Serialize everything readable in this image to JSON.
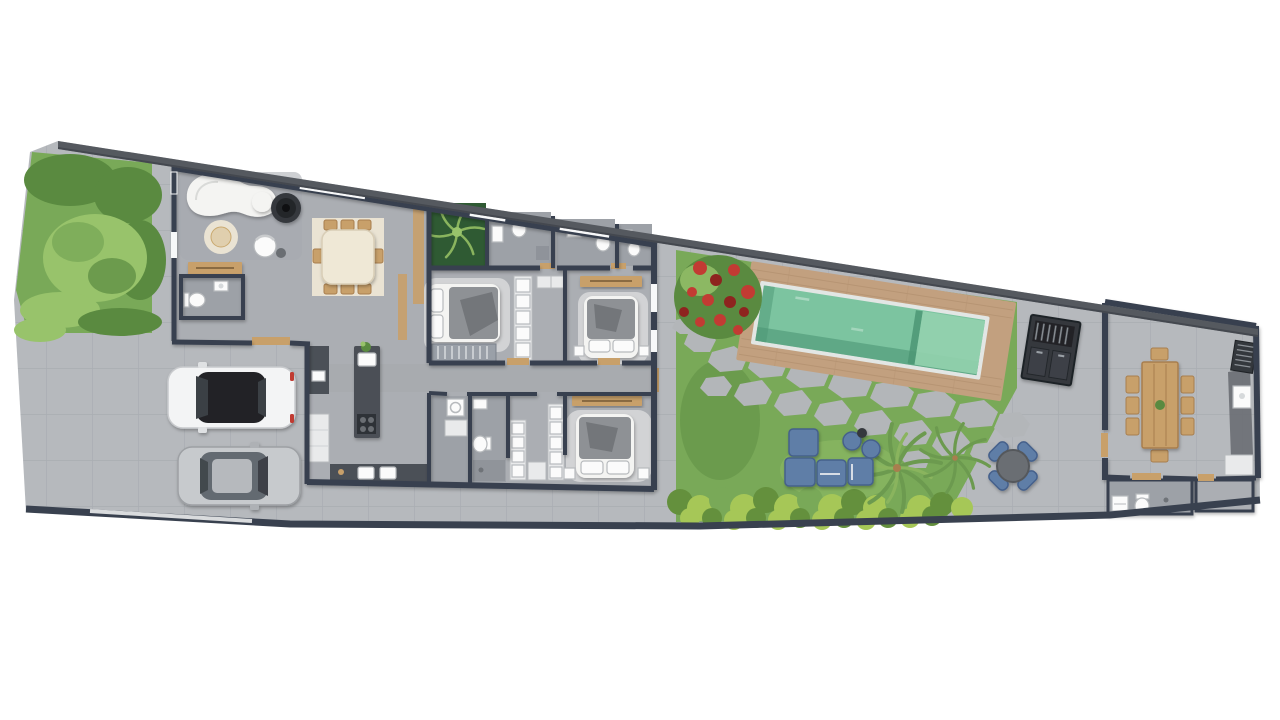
{
  "document": {
    "kind": "architectural-floor-plan-render",
    "view": "top-down site plan",
    "visible_text": []
  },
  "colors": {
    "background": "#ffffff",
    "paving": "#b6b9bd",
    "indoor_floor": "#abaeb3",
    "bath_floor": "#9da1a7",
    "hall_floor": "#a6a9ae",
    "wall": "#39414f",
    "boundary_top": "#55595f",
    "window_white": "#f7f8f9",
    "grass": "#79a958",
    "grass_dark": "#5a8a40",
    "grass_light": "#98c36b",
    "hedge_light": "#a6c757",
    "hedge_dark": "#64903d",
    "planter": "#2f5a33",
    "palm": "#6c9a4f",
    "palm_light": "#8ab45e",
    "flower_red": "#c23b33",
    "flower_dark": "#8e241f",
    "pool_water": "#7cc4a0",
    "pool_deep": "#4c9674",
    "pool_ledge": "#93d2ae",
    "pool_trim": "#e2e6e4",
    "deck": "#c2a07f",
    "deck_line": "#ae8c6b",
    "wood": "#c8a06a",
    "wood_dark": "#a87e4e",
    "rug_cream": "#eae3d3",
    "rug_gray": "#d8d9db",
    "sofa_white": "#f4f4f2",
    "blanket": "#8e9195",
    "blanket_dark": "#73767a",
    "fixture": "#fbfbfb",
    "fixture_stroke": "#b7babd",
    "charcoal": "#34383d",
    "metal": "#6a6e73",
    "island": "#4b5057",
    "cabinet": "#e9eaeb",
    "sofa_blue": "#5e7ea7",
    "sofa_blue_dark": "#45608b",
    "car_white": "#f3f4f5",
    "car_glass": "#202327",
    "car_red": "#c03a31",
    "car_silver": "#c7cacd",
    "car_glass2": "#646a71",
    "stone": "#b3b6b9",
    "gate": "#d9dbdd"
  },
  "scene": {
    "cars": 2,
    "indoor_dining_chairs": 8,
    "gourmet_dining_chairs": 8,
    "patio_round_table_chairs": 4,
    "bedrooms": 3,
    "pool_count": 1
  },
  "elements": [
    "perimeter-wall",
    "front-garden",
    "living-lounge",
    "suspended-fireplace",
    "powder-room",
    "dining-set",
    "courtyard-planter",
    "kitchen-island",
    "laundry",
    "bathroom",
    "walk-in-closet",
    "bedroom-1",
    "bedroom-2",
    "master-bedroom",
    "carport-white-car",
    "carport-silver-car",
    "lap-pool",
    "pool-deck",
    "flagstone-path",
    "lawn",
    "flower-bush",
    "hedge",
    "palm-trees",
    "outdoor-lounge-sofa",
    "outdoor-bbq",
    "patio-round-table",
    "gourmet-room",
    "gourmet-bathroom"
  ]
}
